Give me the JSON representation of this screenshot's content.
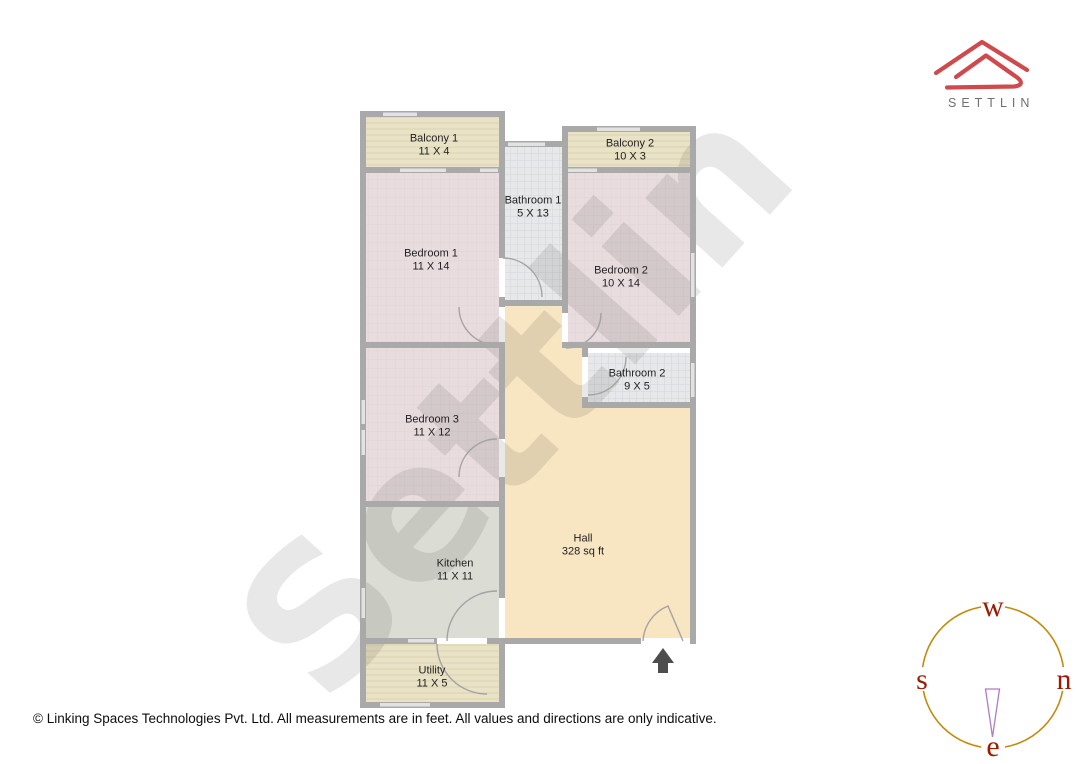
{
  "brand": {
    "name": "SETTLIN",
    "logo_color": "#cf4a4c",
    "text_color": "#6f6f6f"
  },
  "plan": {
    "watermark": "Settlin",
    "rooms": [
      {
        "name": "Balcony 1",
        "dims": "11 X 4"
      },
      {
        "name": "Balcony 2",
        "dims": "10 X 3"
      },
      {
        "name": "Bathroom 1",
        "dims": "5 X 13"
      },
      {
        "name": "Bedroom 1",
        "dims": "11 X 14"
      },
      {
        "name": "Bedroom 2",
        "dims": "10 X 14"
      },
      {
        "name": "Bathroom 2",
        "dims": "9 X 5"
      },
      {
        "name": "Bedroom 3",
        "dims": "11 X 12"
      },
      {
        "name": "Hall",
        "dims": "328 sq ft"
      },
      {
        "name": "Kitchen",
        "dims": "11 X 11"
      },
      {
        "name": "Utility",
        "dims": "11 X 5"
      }
    ],
    "colors": {
      "wall": "#a9a9a9",
      "window": "#e2e2e2",
      "door_arc": "#a3a3a3",
      "balcony": "#e9e2c6",
      "bedroom": "#e8dcdf",
      "bathroom": "#e6e8ea",
      "kitchen": "#dbddd5",
      "hall": "#f8e5c2",
      "utility": "#e9e2c6",
      "entrance_arrow": "#4d4d4d",
      "watermark": "#00000017"
    }
  },
  "compass": {
    "points": {
      "top": "w",
      "left": "s",
      "right": "n",
      "bottom": "e"
    },
    "ring_color": "#c28a0a",
    "letter_color": "#9b1b00",
    "needle_color": "#b07cc6"
  },
  "footer": {
    "copyright": "© Linking Spaces Technologies Pvt. Ltd. All measurements are in feet. All values and directions are only indicative."
  }
}
